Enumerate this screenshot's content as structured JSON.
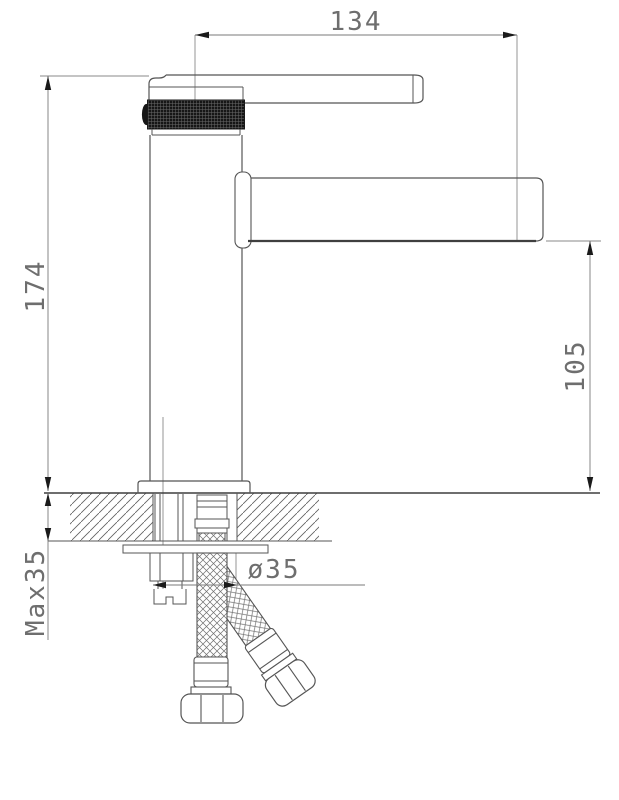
{
  "drawing": {
    "background_color": "#ffffff",
    "line_color": "#555555",
    "dimension_color": "#6e6e6e"
  },
  "dimensions": {
    "spout_reach": "134",
    "overall_height": "174",
    "spout_outlet_height": "105",
    "max_mounting_thickness": "Max35",
    "mounting_hole_diameter": "ø35"
  }
}
